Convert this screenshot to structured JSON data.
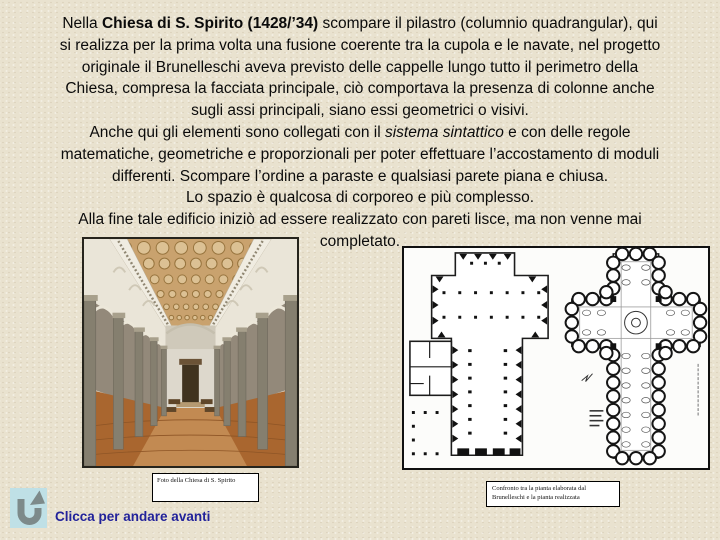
{
  "slide": {
    "background_color": "#E9E2CF"
  },
  "paragraph": {
    "lines": [
      [
        {
          "t": "Nella ",
          "s": ""
        },
        {
          "t": "Chiesa di S. Spirito (1428/’34)",
          "s": "b"
        },
        {
          "t": " scompare il pilastro (columnio quadrangular), qui",
          "s": ""
        }
      ],
      [
        {
          "t": "si realizza per la prima volta una fusione coerente tra la cupola e le navate, nel progetto",
          "s": ""
        }
      ],
      [
        {
          "t": "originale il Brunelleschi aveva previsto delle cappelle lungo tutto il perimetro della",
          "s": ""
        }
      ],
      [
        {
          "t": "Chiesa, compresa la facciata principale, ciò comportava la presenza di colonne anche",
          "s": ""
        }
      ],
      [
        {
          "t": "sugli assi principali, siano essi geometrici o visivi.",
          "s": ""
        }
      ],
      [
        {
          "t": "Anche qui gli elementi sono collegati con il ",
          "s": ""
        },
        {
          "t": "sistema sintattico",
          "s": "i"
        },
        {
          "t": " e con delle regole",
          "s": ""
        }
      ],
      [
        {
          "t": "matematiche, geometriche e proporzionali per poter effettuare l’accostamento di moduli",
          "s": ""
        }
      ],
      [
        {
          "t": "differenti. Scompare l’ordine a paraste e qualsiasi parete piana e chiusa.",
          "s": ""
        }
      ],
      [
        {
          "t": "Lo spazio è qualcosa di corporeo e più complesso.",
          "s": ""
        }
      ],
      [
        {
          "t": "Alla fine tale edificio iniziò ad essere realizzato con pareti lisce, ma non venne mai",
          "s": ""
        }
      ],
      [
        {
          "t": "completato.",
          "s": ""
        }
      ]
    ]
  },
  "photo_caption": {
    "text": "Foto della Chiesa di S. Spirito"
  },
  "plans_caption": {
    "line1": "Confronto tra la pianta elaborata dal",
    "line2": "Brunelleschi e la pianta realizzata"
  },
  "nav": {
    "label": "Clicca per andare avanti",
    "label_color": "#22229A",
    "icon": "u-turn-arrow-icon",
    "icon_bg": "#BFE0E6",
    "icon_color": "#7D8A8A"
  }
}
